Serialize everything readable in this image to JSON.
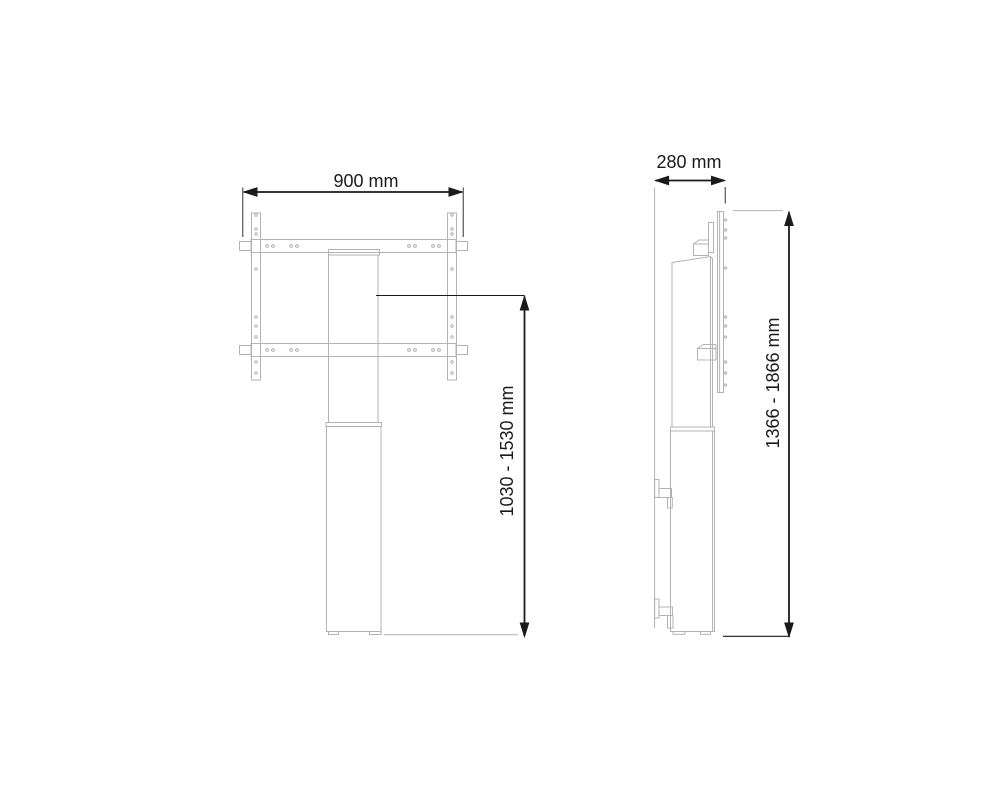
{
  "colors": {
    "outline": "#b3b3b3",
    "dimension": "#1a1a1a",
    "background": "#ffffff"
  },
  "dimensions": {
    "front_width": {
      "label": "900 mm",
      "value_mm": 900
    },
    "front_height": {
      "label": "1030 - 1530 mm",
      "min_mm": 1030,
      "max_mm": 1530
    },
    "side_depth": {
      "label": "280 mm",
      "value_mm": 280
    },
    "side_height": {
      "label": "1366 - 1866 mm",
      "min_mm": 1366,
      "max_mm": 1866
    }
  }
}
